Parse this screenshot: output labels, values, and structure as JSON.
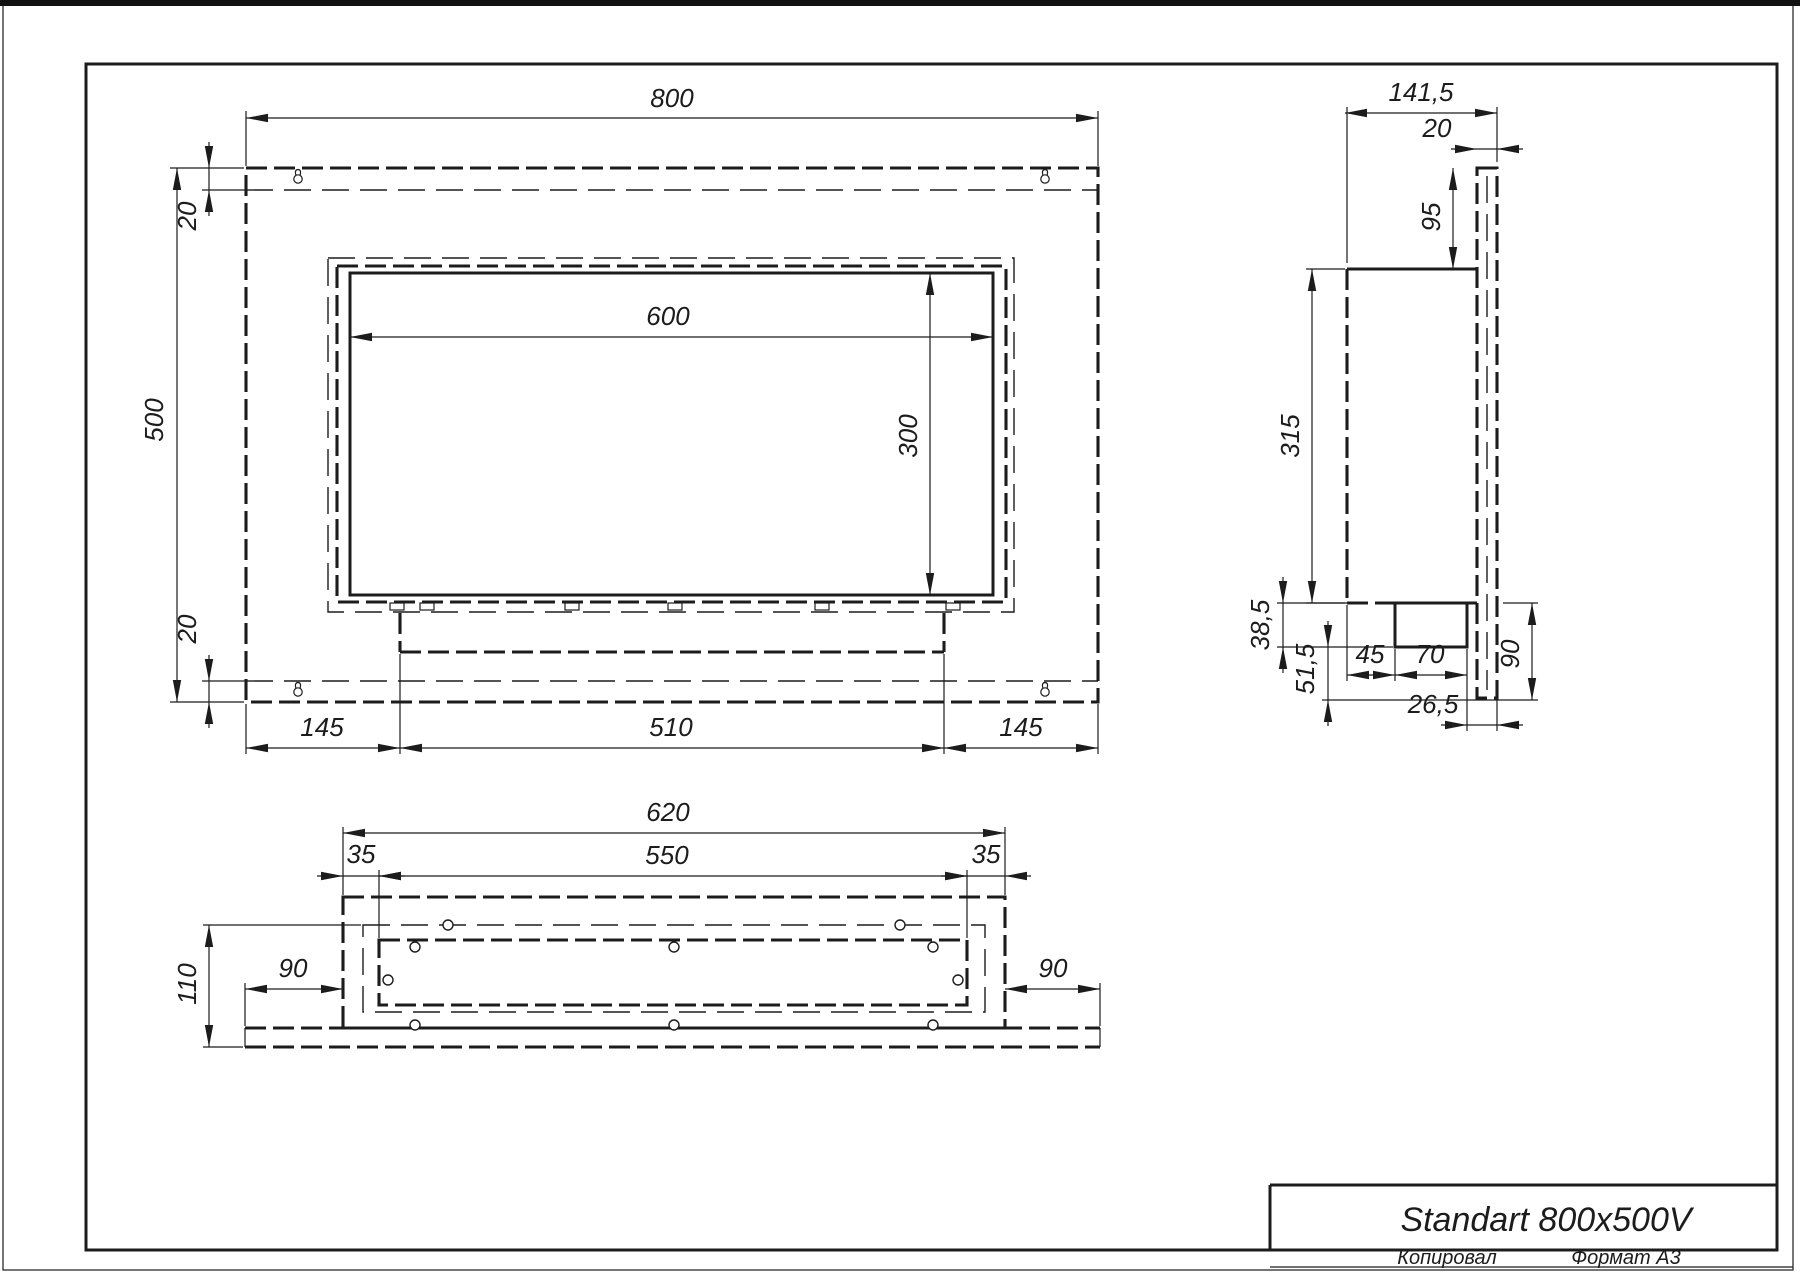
{
  "drawing": {
    "title": "Standart 800x500V",
    "footer": {
      "copied_label": "Копировал",
      "format_label": "Формат А3"
    },
    "colors": {
      "line": "#1c1c1c",
      "background": "#ffffff"
    },
    "views": {
      "front": {
        "label": "front-view",
        "dims": {
          "width": "800",
          "height": "500",
          "flange_top": "20",
          "flange_bottom": "20",
          "opening_width": "600",
          "opening_height": "300",
          "tray_offset_left": "145",
          "tray_width": "510",
          "tray_offset_right": "145"
        }
      },
      "side": {
        "label": "side-view",
        "dims": {
          "depth_total": "141,5",
          "plate_thickness": "20",
          "top_offset": "95",
          "box_height": "315",
          "tank_drop": "38,5",
          "bottom_gap": "51,5",
          "tank_offset": "45",
          "tank_depth": "70",
          "tank_to_back": "26,5",
          "bottom_height": "90"
        }
      },
      "bottom": {
        "label": "bottom-view",
        "dims": {
          "box_width": "620",
          "inner_width": "550",
          "margin_left": "35",
          "margin_right": "35",
          "depth": "110",
          "side_left": "90",
          "side_right": "90"
        }
      }
    }
  }
}
